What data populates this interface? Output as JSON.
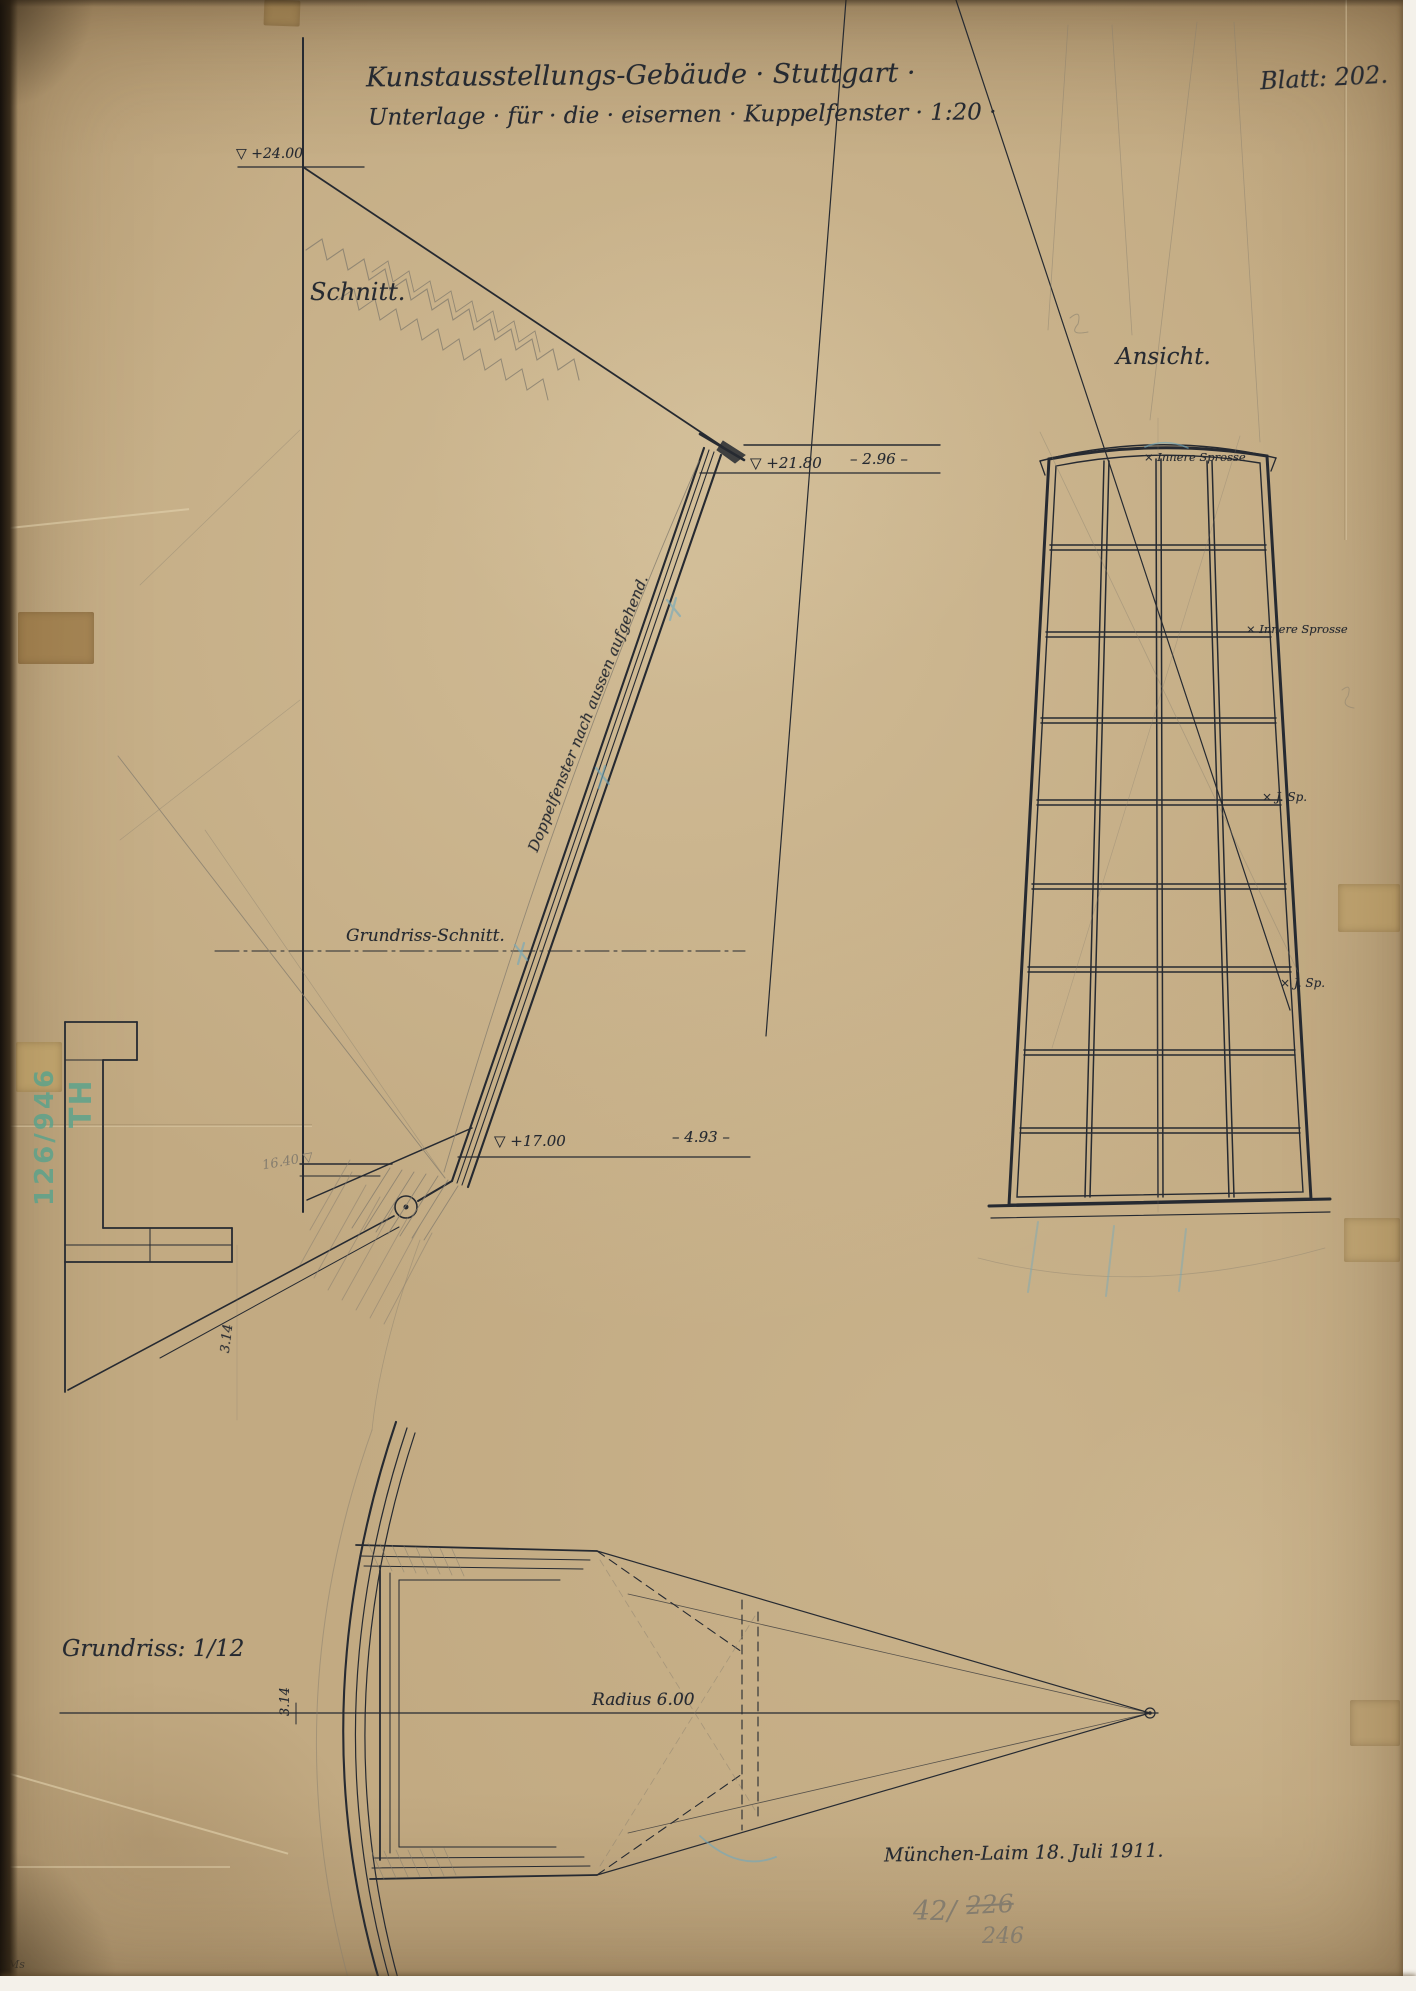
{
  "sheet": {
    "title_line1": "Kunstausstellungs-Gebäude · Stuttgart ·",
    "title_line2": "Unterlage · für · die · eisernen · Kuppelfenster · 1:20 ·",
    "sheet_number": "Blatt: 202.",
    "place_date": "München-Laim 18. Juli 1911."
  },
  "section_view": {
    "label": "Schnitt.",
    "elevation_top": "▽ +24.00",
    "elevation_middle": "▽ +21.80",
    "elevation_sill": "▽ +17.00",
    "width_middle": "– 2.96 –",
    "width_sill": "– 4.93 –",
    "centerline_label": "Grundriss-Schnitt.",
    "window_note": "Doppelfenster nach aussen aufgehend.",
    "pencil_elevation": "16.40 ▽",
    "dim_vertical": "3.14"
  },
  "elevation_view": {
    "label": "Ansicht.",
    "annotations": [
      "× Innere Sprosse",
      "× Innere Sprosse",
      "× J. Sp.",
      "× J. Sp."
    ]
  },
  "plan_view": {
    "label": "Grundriss: 1/12",
    "radius_label": "Radius 6.00",
    "dim_arc": "3.14"
  },
  "marks": {
    "stamp_number": "126/946",
    "stamp_monogram": "TH",
    "pencil_ref_prefix": "42/",
    "pencil_ref_struck": "226",
    "pencil_ref_revised": "246",
    "corner_initials": "Ms"
  },
  "colors": {
    "paper": "#c2aa82",
    "ink": "#262a31",
    "pencil": "#857d6e",
    "blue_pencil": "#6fa9bf",
    "stamp_green": "#55a38d"
  }
}
